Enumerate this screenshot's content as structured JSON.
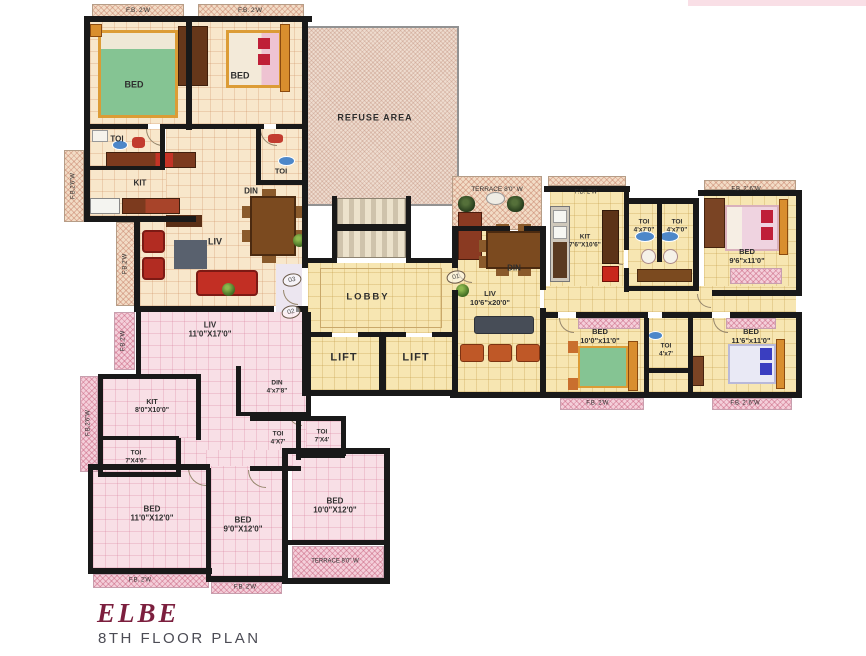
{
  "footer": {
    "logo": "ELBE",
    "title": "8TH  FLOOR PLAN"
  },
  "colors": {
    "wall": "#191919",
    "cream_floor": "#f8e7cb",
    "yellow_floor": "#f7e6b2",
    "pink_floor": "#f8dfe6",
    "hatch_cream": "#f2dcc6",
    "hatch_pink": "#f4cfda",
    "refuse": "#eedccf",
    "logo": "#7c1f3e",
    "title": "#4c4c55",
    "label": "#2e2e2e"
  },
  "flat_markers": [
    {
      "no": "01",
      "x": 456,
      "y": 277
    },
    {
      "no": "02",
      "x": 291,
      "y": 312
    },
    {
      "no": "03",
      "x": 292,
      "y": 280
    }
  ],
  "labels": [
    {
      "name": "fb-top-left-1",
      "text": "F.B. 2'W",
      "x": 138,
      "y": 11,
      "fs": 6.5
    },
    {
      "name": "fb-top-left-2",
      "text": "F.B. 2'W",
      "x": 250,
      "y": 11,
      "fs": 6.5
    },
    {
      "name": "room-bed-top-left",
      "text": "BED",
      "x": 134,
      "y": 85,
      "fs": 9,
      "bold": true
    },
    {
      "name": "room-bed-top-mid",
      "text": "BED",
      "x": 240,
      "y": 76,
      "fs": 9,
      "bold": true
    },
    {
      "name": "room-toi-top-left",
      "text": "TOI",
      "x": 117,
      "y": 139,
      "fs": 8,
      "bold": true
    },
    {
      "name": "room-kit-top-left",
      "text": "KIT",
      "x": 140,
      "y": 183,
      "fs": 8,
      "bold": true
    },
    {
      "name": "room-din-top-left",
      "text": "DIN",
      "x": 251,
      "y": 191,
      "fs": 8,
      "bold": true
    },
    {
      "name": "room-liv-top-left",
      "text": "LIV",
      "x": 215,
      "y": 242,
      "fs": 9,
      "bold": true
    },
    {
      "name": "fb-left-strip-1",
      "text": "F.B.2'6\"W",
      "x": 74,
      "y": 186,
      "fs": 6,
      "rot": -90
    },
    {
      "name": "fb-left-strip-2",
      "text": "F.B.2'W",
      "x": 126,
      "y": 264,
      "fs": 6,
      "rot": -90
    },
    {
      "name": "room-toi-core",
      "text": "TOI",
      "x": 281,
      "y": 172,
      "fs": 7.5,
      "bold": true
    },
    {
      "name": "refuse-area",
      "text": "REFUSE AREA",
      "x": 375,
      "y": 118,
      "fs": 9,
      "bold": true,
      "ls": 1
    },
    {
      "name": "lobby",
      "text": "LOBBY",
      "x": 368,
      "y": 297,
      "fs": 9.5,
      "bold": true,
      "ls": 2
    },
    {
      "name": "lift-1",
      "text": "LIFT",
      "x": 344,
      "y": 358,
      "fs": 11,
      "bold": true,
      "ls": 1
    },
    {
      "name": "lift-2",
      "text": "LIFT",
      "x": 416,
      "y": 358,
      "fs": 11,
      "bold": true,
      "ls": 1
    },
    {
      "name": "terrace-right",
      "text": "TERRACE 8'0\" W",
      "x": 497,
      "y": 190,
      "fs": 6.5
    },
    {
      "name": "fb-kit-right",
      "text": "F.B. 2'W",
      "x": 586,
      "y": 193,
      "fs": 6
    },
    {
      "name": "room-din-right",
      "text": "DIN",
      "x": 514,
      "y": 268,
      "fs": 8,
      "bold": true
    },
    {
      "name": "room-kit-right",
      "text": "KIT\n7'6\"X10'6\"",
      "x": 585,
      "y": 241,
      "fs": 6.5,
      "bold": true
    },
    {
      "name": "room-toi-right-1",
      "text": "TOI\n4'x7'0\"",
      "x": 644,
      "y": 226,
      "fs": 6.5,
      "bold": true
    },
    {
      "name": "room-toi-right-2",
      "text": "TOI\n4'x7'0\"",
      "x": 677,
      "y": 226,
      "fs": 6.5,
      "bold": true
    },
    {
      "name": "fb-top-right",
      "text": "F.B. 2'.6\"W",
      "x": 746,
      "y": 190,
      "fs": 6
    },
    {
      "name": "room-bed-top-right",
      "text": "BED\n9'6\"x11'0\"",
      "x": 747,
      "y": 257,
      "fs": 7.5,
      "bold": true
    },
    {
      "name": "room-liv-right",
      "text": "LIV\n10'6\"x20'0\"",
      "x": 490,
      "y": 299,
      "fs": 7.5,
      "bold": true
    },
    {
      "name": "room-bed-mid-right",
      "text": "BED\n10'0\"x11'0\"",
      "x": 600,
      "y": 337,
      "fs": 7.5,
      "bold": true
    },
    {
      "name": "room-toi-mid-right",
      "text": "TOI\n4'x7'",
      "x": 666,
      "y": 350,
      "fs": 6.5,
      "bold": true
    },
    {
      "name": "room-bed-far-right",
      "text": "BED\n11'6\"x11'0\"",
      "x": 751,
      "y": 337,
      "fs": 7.5,
      "bold": true
    },
    {
      "name": "fb-bottom-mid-1",
      "text": "F.B. 2'W.",
      "x": 598,
      "y": 404,
      "fs": 6
    },
    {
      "name": "fb-bottom-mid-2",
      "text": "F.B. 2'.6\"W",
      "x": 745,
      "y": 404,
      "fs": 6
    },
    {
      "name": "room-liv-pink",
      "text": "LIV\n11'0\"X17'0\"",
      "x": 210,
      "y": 330,
      "fs": 8,
      "bold": true
    },
    {
      "name": "room-kit-pink",
      "text": "KIT\n8'0\"X10'0\"",
      "x": 152,
      "y": 407,
      "fs": 7,
      "bold": true
    },
    {
      "name": "room-toi-pink-1",
      "text": "TOI\n7'X4'6\"",
      "x": 136,
      "y": 457,
      "fs": 6.5,
      "bold": true
    },
    {
      "name": "room-din-pink",
      "text": "DIN\n4'x7'8\"",
      "x": 277,
      "y": 387,
      "fs": 6.5,
      "bold": true
    },
    {
      "name": "room-toi-pink-2",
      "text": "TOI\n4'X7'",
      "x": 278,
      "y": 438,
      "fs": 6.5,
      "bold": true
    },
    {
      "name": "room-toi-pink-3",
      "text": "TOI\n7'X4'",
      "x": 322,
      "y": 436,
      "fs": 6.5,
      "bold": true
    },
    {
      "name": "room-bed-pink-1",
      "text": "BED\n11'0\"X12'0\"",
      "x": 152,
      "y": 514,
      "fs": 8,
      "bold": true
    },
    {
      "name": "room-bed-pink-2",
      "text": "BED\n9'0\"X12'0\"",
      "x": 243,
      "y": 525,
      "fs": 8,
      "bold": true
    },
    {
      "name": "room-bed-pink-3",
      "text": "BED\n10'0\"X12'0\"",
      "x": 335,
      "y": 506,
      "fs": 8,
      "bold": true
    },
    {
      "name": "terrace-pink",
      "text": "TERRACE 8'0\" W",
      "x": 335,
      "y": 562,
      "fs": 6
    },
    {
      "name": "fb-bottom-pink-1",
      "text": "F.B. 2'W",
      "x": 140,
      "y": 581,
      "fs": 6
    },
    {
      "name": "fb-bottom-pink-2",
      "text": "F.B. 2'W",
      "x": 245,
      "y": 588,
      "fs": 6
    },
    {
      "name": "fb-left-pink-1",
      "text": "F.B.2'6\"W",
      "x": 89,
      "y": 423,
      "fs": 6,
      "rot": -90
    },
    {
      "name": "fb-left-pink-2",
      "text": "F.B.2'W",
      "x": 124,
      "y": 341,
      "fs": 6,
      "rot": -90
    }
  ]
}
